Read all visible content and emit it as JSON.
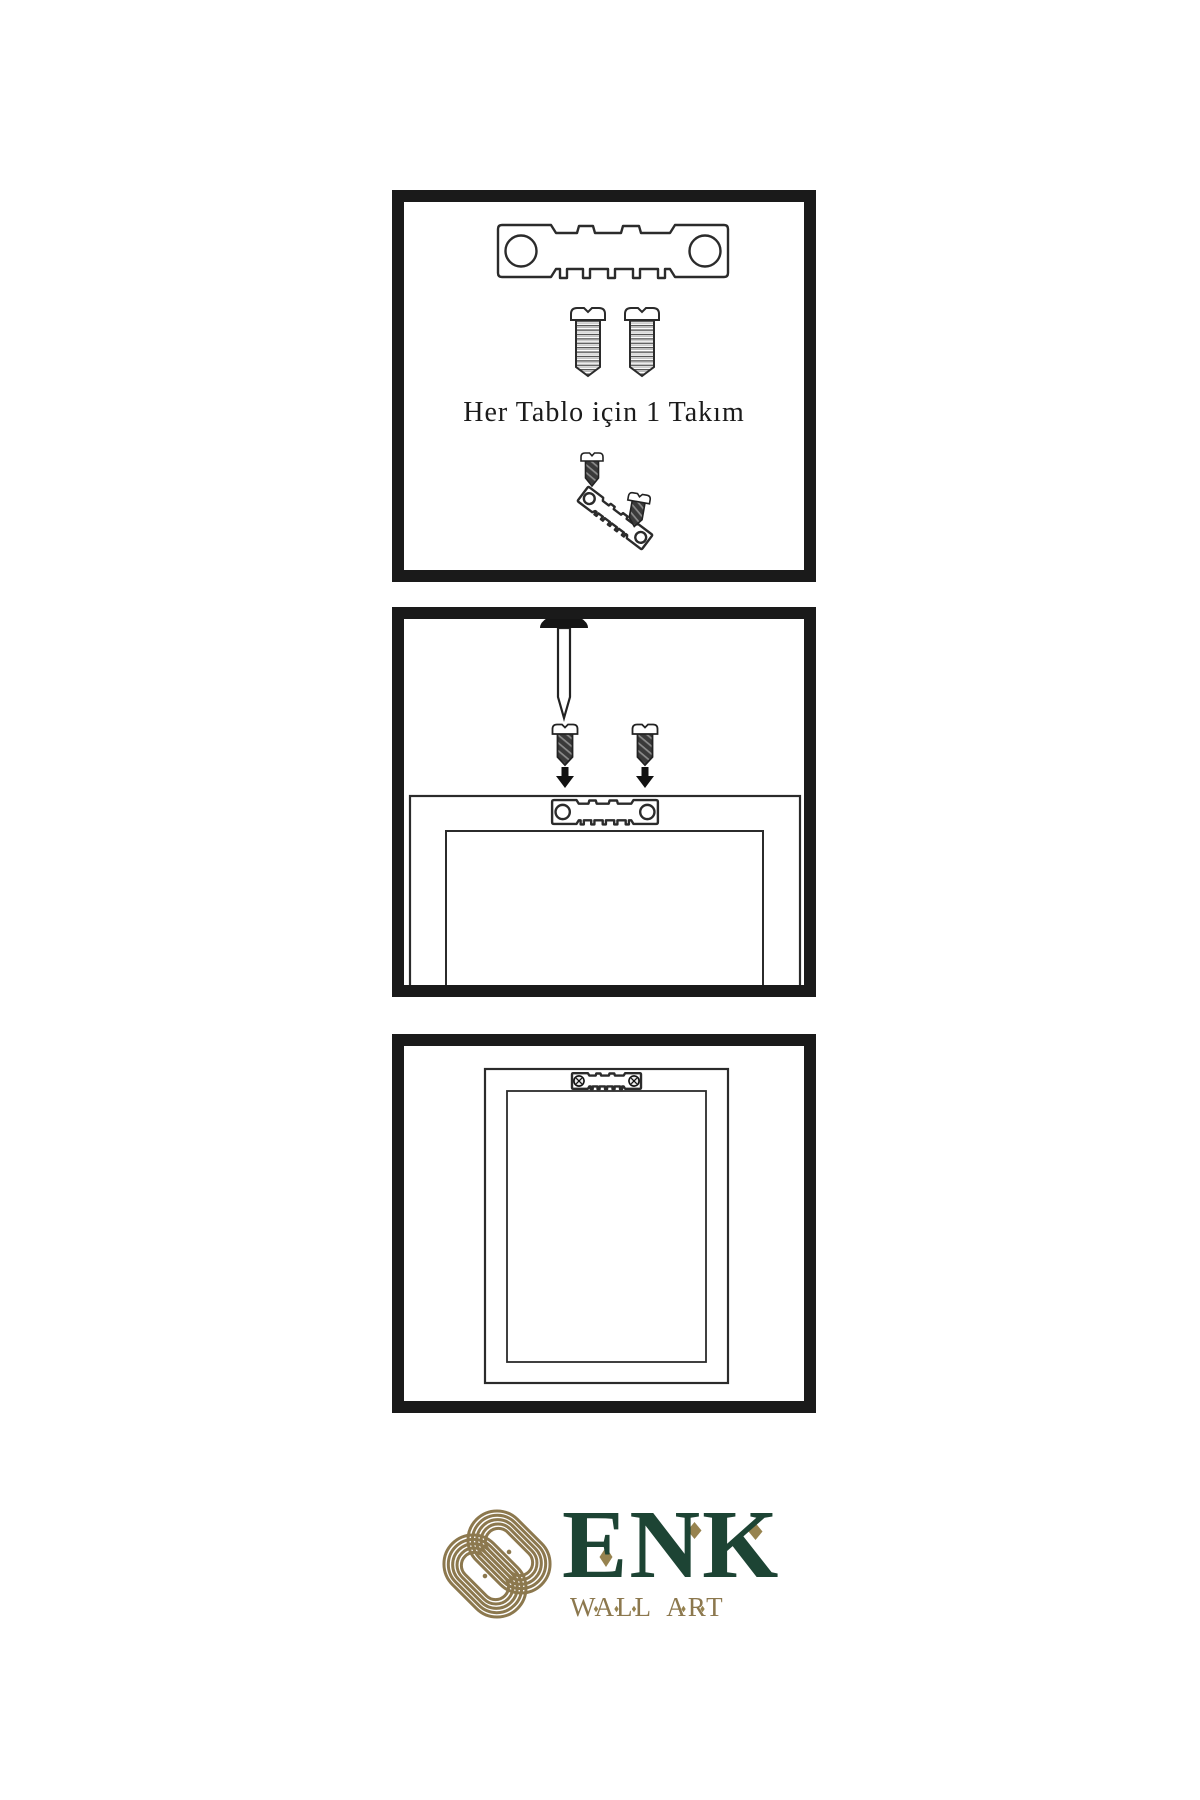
{
  "page": {
    "background": "#ffffff"
  },
  "panel1": {
    "caption": "Her Tablo için 1 Takım",
    "items": [
      "sawtooth-hanger",
      "mounting-screw",
      "mounting-screw",
      "screw-into-hanger-detail"
    ]
  },
  "panel2": {
    "items": [
      "wall-nail",
      "mounting-screw",
      "mounting-screw",
      "down-arrow",
      "down-arrow",
      "frame-back-with-sawtooth-hanger"
    ]
  },
  "panel3": {
    "items": [
      "framed-picture-hanging-on-wall"
    ]
  },
  "logo": {
    "brand": "ENK",
    "subtitle": "WALL ART",
    "icon": "knot-logo-icon",
    "colors": {
      "green": "#1d4434",
      "gold": "#8c784e"
    }
  },
  "colors": {
    "ink": "#1a1a1a",
    "line": "#2b2b2b",
    "screw_dark": "#3a3a3a"
  },
  "icons": {
    "sawtooth-hanger-icon": "stamped metal strip, 2 round holes, sawtooth teeth",
    "screw-threaded-icon": "round head screw with horizontal threads",
    "screw-dark-icon": "dark screw with diagonal hatch",
    "nail-icon": "wall nail with dome head",
    "down-arrow-icon": "solid black arrow",
    "frame-icon": "double rectangle picture frame",
    "knot-logo-icon": "gold interlaced knot"
  }
}
